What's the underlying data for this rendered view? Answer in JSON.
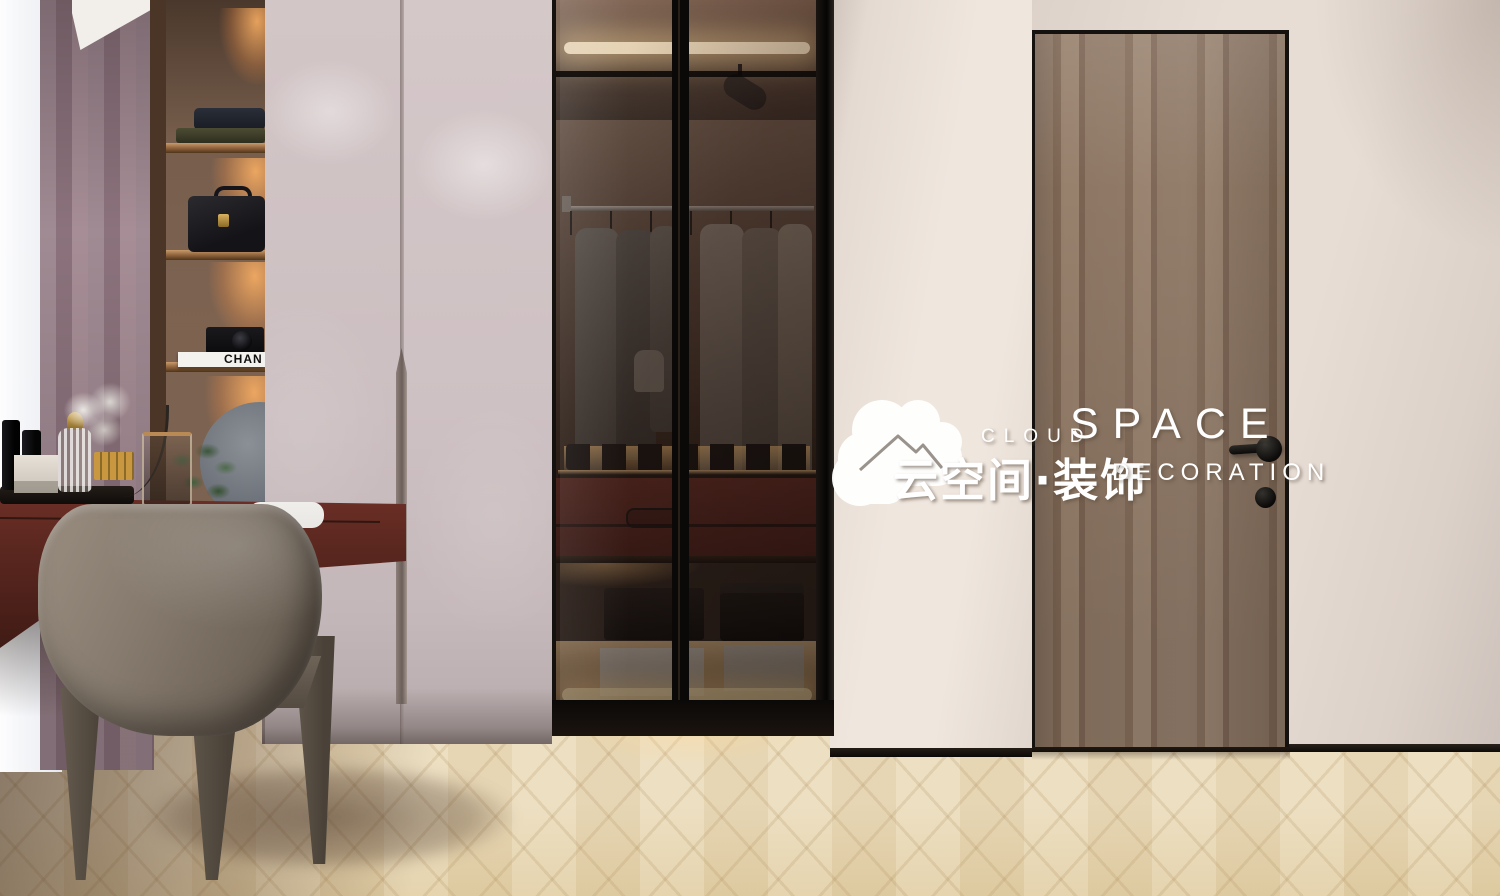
{
  "scene": {
    "type": "interior-3d-render",
    "description": "walk-in cloakroom with blush wardrobe, smoked-glass display closet, wooden entry door, dressing table with chair on herringbone oak floor"
  },
  "watermark": {
    "icon": "cloud-house-logo",
    "brand_top_small": "CLOUD",
    "brand_top_large": "SPACE",
    "brand_cn": "云空间·装饰",
    "brand_bottom": "DECORATION",
    "color": "#ffffff"
  },
  "objects": {
    "book_spine_text": "CHAN",
    "shelving_items": [
      "folded-clothes",
      "leather-briefcase",
      "camera",
      "white-book",
      "round-mirror",
      "green-plant"
    ],
    "desk_items": [
      "cosmetics-tray",
      "black-bottles",
      "white-box",
      "ribbed-perfume-bottle",
      "gold-lipsticks",
      "glass-vase",
      "white-flower-puff"
    ],
    "cabinet_items": [
      "track-spotlight",
      "led-strips",
      "clothes-rail",
      "hanging-jackets",
      "shoe-row",
      "burgundy-drawers",
      "eyeglasses",
      "black-boxes",
      "grey-boxes"
    ]
  },
  "palette": {
    "wall": "#e7ddd5",
    "wall-light": "#efe6de",
    "floor": "#ebdcbc",
    "floor-dark": "#e2cfa6",
    "frame-black": "#14110e",
    "door-wood": "#8d7663",
    "door-wood-dark": "#806855",
    "wardrobe": "#cdc0c2",
    "desk": "#5c2820",
    "burgundy": "#5a241d",
    "curtain": "#a08a93",
    "sheer": "#f3f4f7",
    "chair": "#857a6d",
    "cushion": "#e9e7e3",
    "led-warm": "#ffedc9",
    "niche-wood": "#4a3526",
    "mirror-grey": "#767b83",
    "plant-green": "#4e6b4a",
    "gold": "#c9973f",
    "white": "#ffffff"
  }
}
